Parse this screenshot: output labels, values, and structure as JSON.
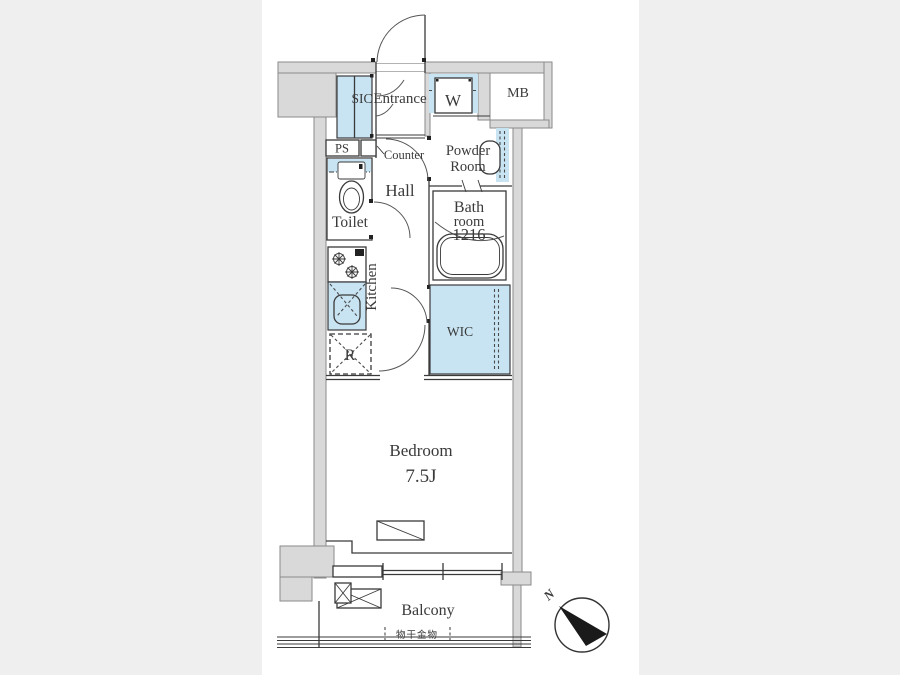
{
  "plan": {
    "rooms": {
      "sic": {
        "label": "SIC"
      },
      "entrance": {
        "label": "Entrance"
      },
      "powder_room": {
        "label_line1": "Powder",
        "label_line2": "Room"
      },
      "hall": {
        "label": "Hall"
      },
      "toilet": {
        "label": "Toilet"
      },
      "bathroom": {
        "label_line1": "Bath",
        "label_line2": "room",
        "label_line3": "1216"
      },
      "kitchen": {
        "label": "Kitchen"
      },
      "wic": {
        "label": "WIC"
      },
      "bedroom": {
        "label": "Bedroom",
        "size": "7.5J"
      },
      "balcony": {
        "label": "Balcony"
      }
    },
    "fixtures": {
      "washing_machine": {
        "label": "W"
      },
      "meter_box": {
        "label": "MB"
      },
      "pipe_space": {
        "label": "PS"
      },
      "refrigerator": {
        "label": "R"
      },
      "counter": {
        "label": "Counter"
      },
      "laundry_hardware": {
        "label": "物干金物"
      }
    },
    "compass": {
      "north": "N"
    },
    "colors": {
      "highlight": "#c8e4f3",
      "wall": "#d9d9d9",
      "line": "#3a3a3a",
      "paper": "#ffffff",
      "background": "#efefef"
    }
  }
}
